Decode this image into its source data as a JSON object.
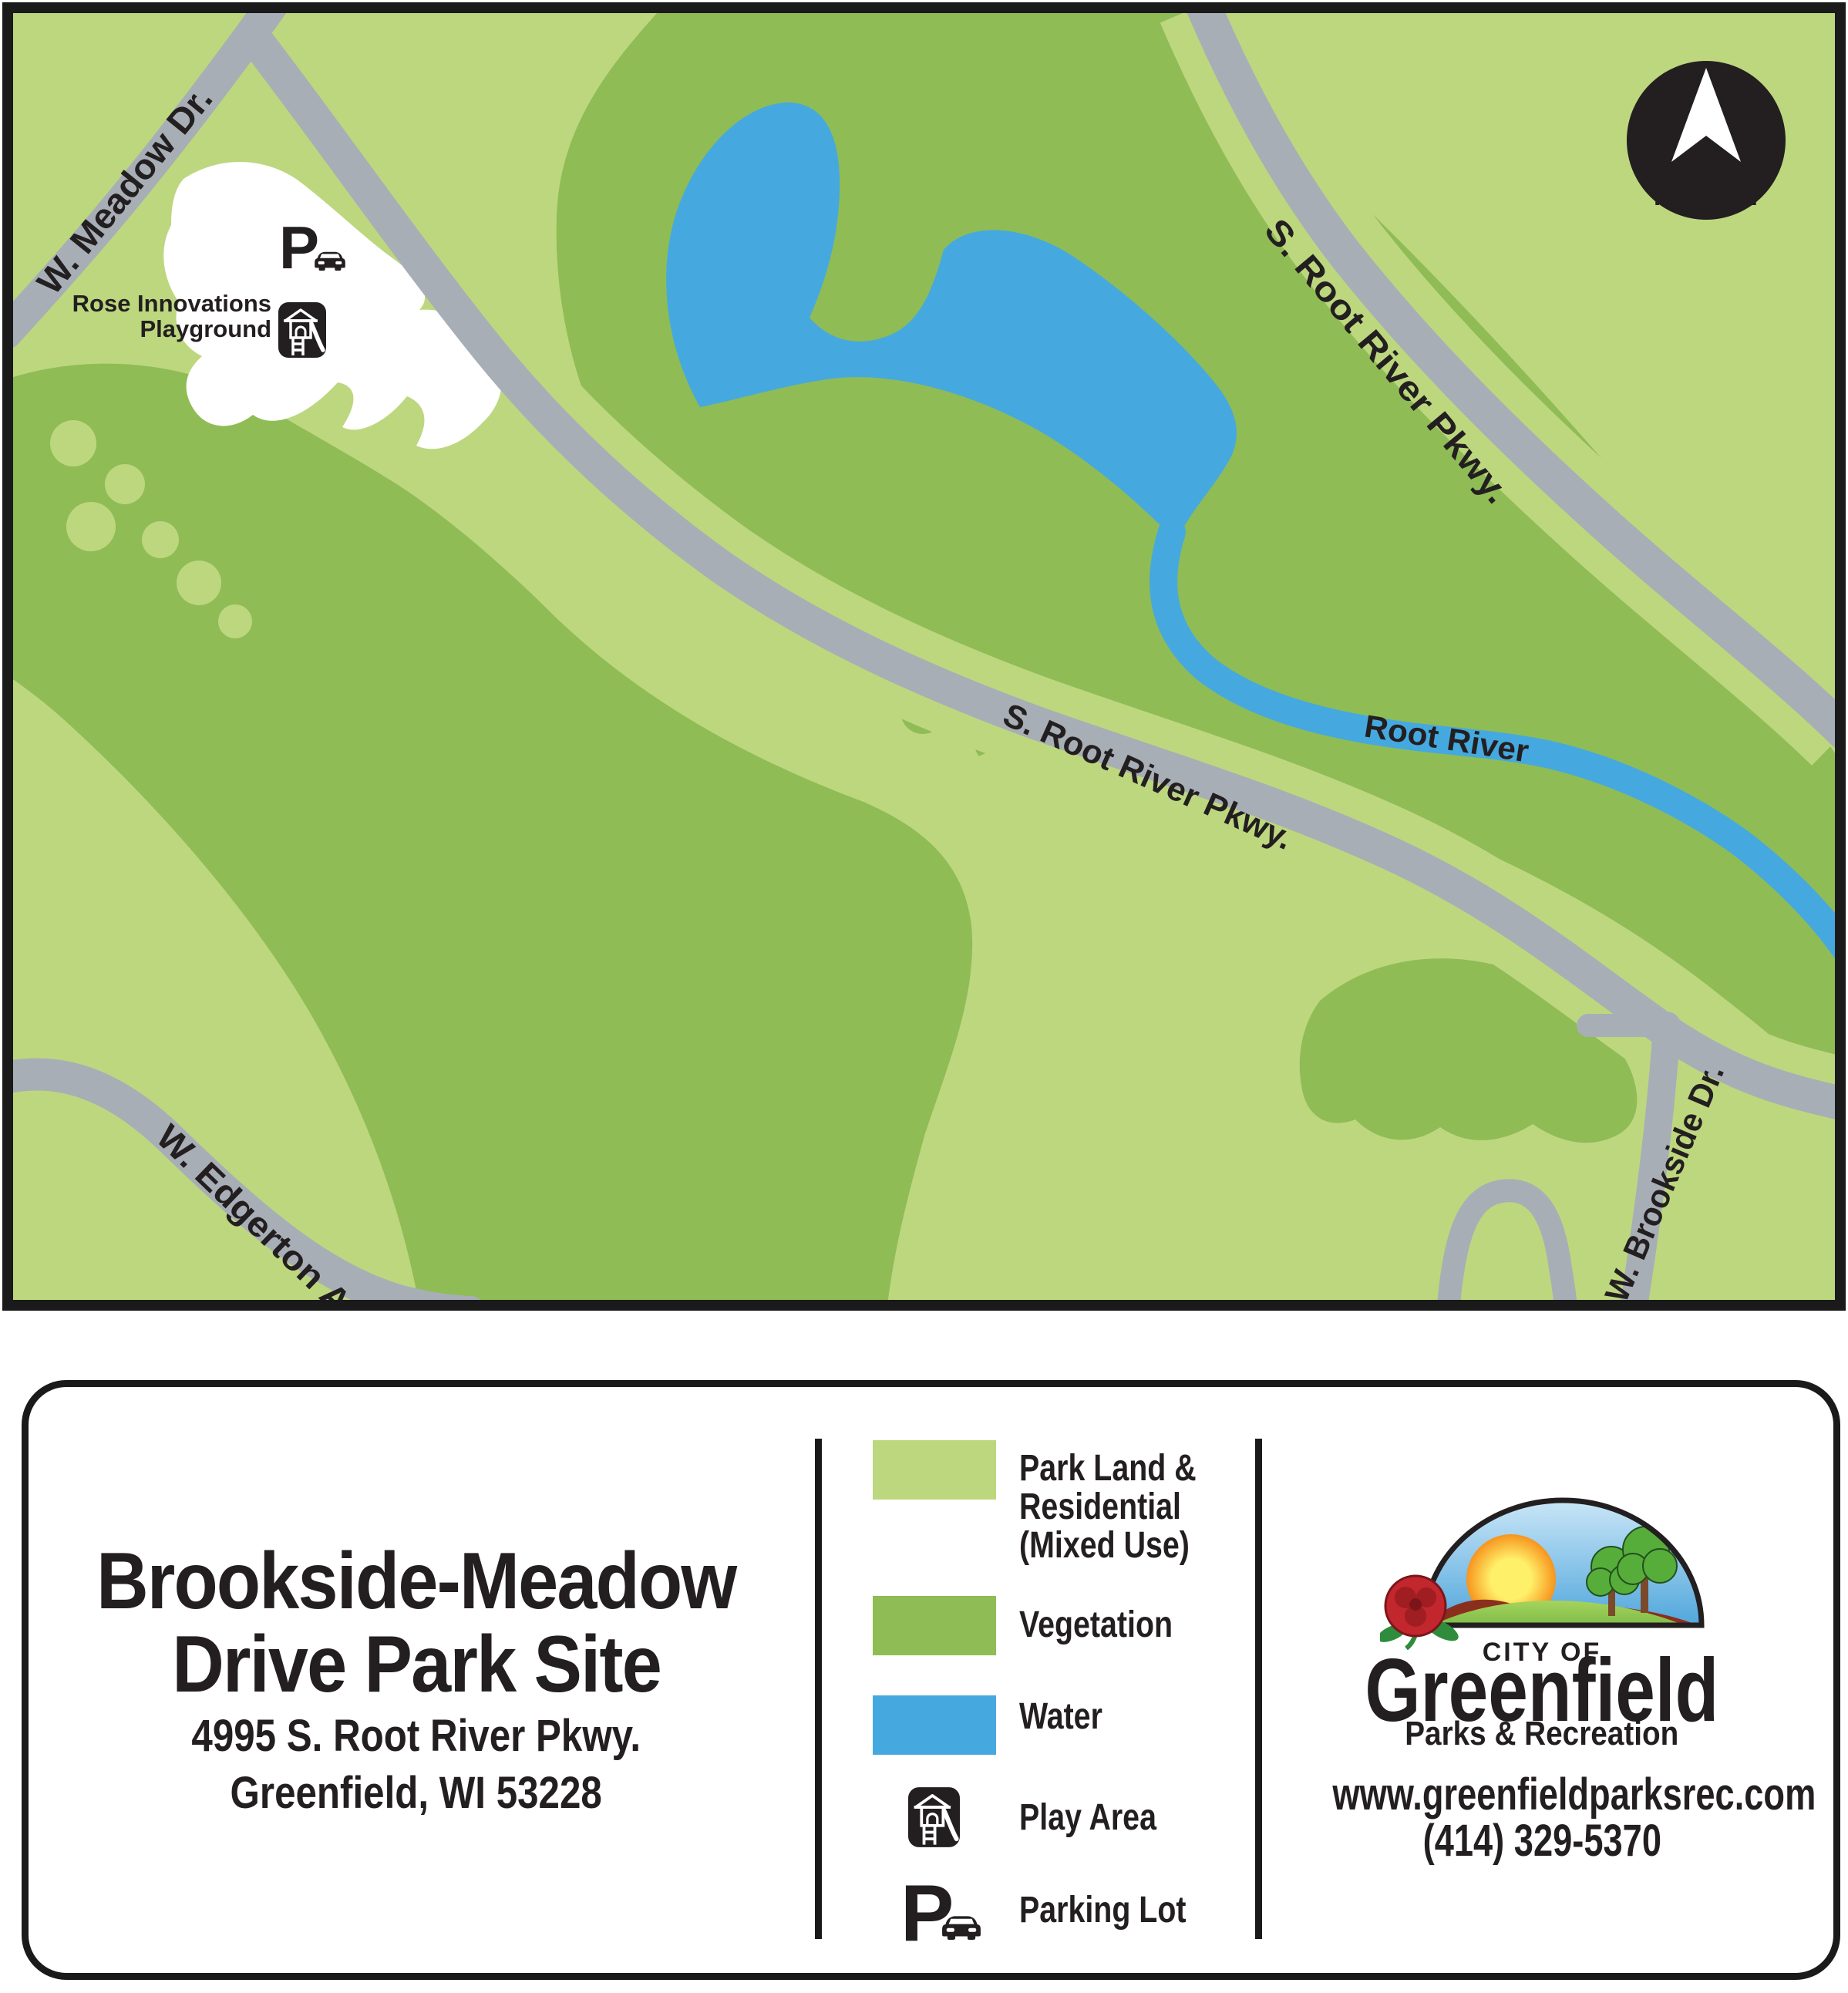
{
  "map": {
    "north_badge": {
      "label": "NORTH"
    },
    "road_labels": {
      "meadow": "W. Meadow Dr.",
      "root_river_pkwy_north": "S. Root River Pkwy.",
      "root_river_pkwy_mid": "S. Root River Pkwy.",
      "edgerton": "W. Edgerton Ave.",
      "brookside": "W. Brookside Dr."
    },
    "water_label": "Root River",
    "playground": {
      "line1": "Rose Innovations",
      "line2": "Playground"
    },
    "parking_glyph": "P"
  },
  "panel": {
    "title": {
      "line1": "Brookside-Meadow",
      "line2": "Drive Park Site"
    },
    "address": {
      "line1": "4995 S. Root River Pkwy.",
      "line2": "Greenfield, WI 53228"
    },
    "legend": {
      "items": [
        {
          "type": "swatch",
          "color": "#bdd77f",
          "lines": [
            "Park Land &",
            "Residential",
            "(Mixed Use)"
          ]
        },
        {
          "type": "swatch",
          "color": "#8fbc55",
          "lines": [
            "Vegetation"
          ]
        },
        {
          "type": "swatch",
          "color": "#45a9df",
          "lines": [
            "Water"
          ]
        },
        {
          "type": "icon",
          "icon": "play-area-icon",
          "lines": [
            "Play Area"
          ]
        },
        {
          "type": "icon",
          "icon": "parking-icon",
          "lines": [
            "Parking Lot"
          ]
        }
      ],
      "parking_glyph": "P"
    },
    "logo": {
      "city_of": "CITY OF",
      "city": "Greenfield",
      "department": "Parks & Recreation"
    },
    "website": "www.greenfieldparksrec.com",
    "phone": "(414) 329-5370"
  },
  "colors": {
    "park_land": "#bdd77f",
    "vegetation": "#8fbc55",
    "water": "#45a9df",
    "road": "#a8aeb5",
    "ink": "#231f20"
  }
}
